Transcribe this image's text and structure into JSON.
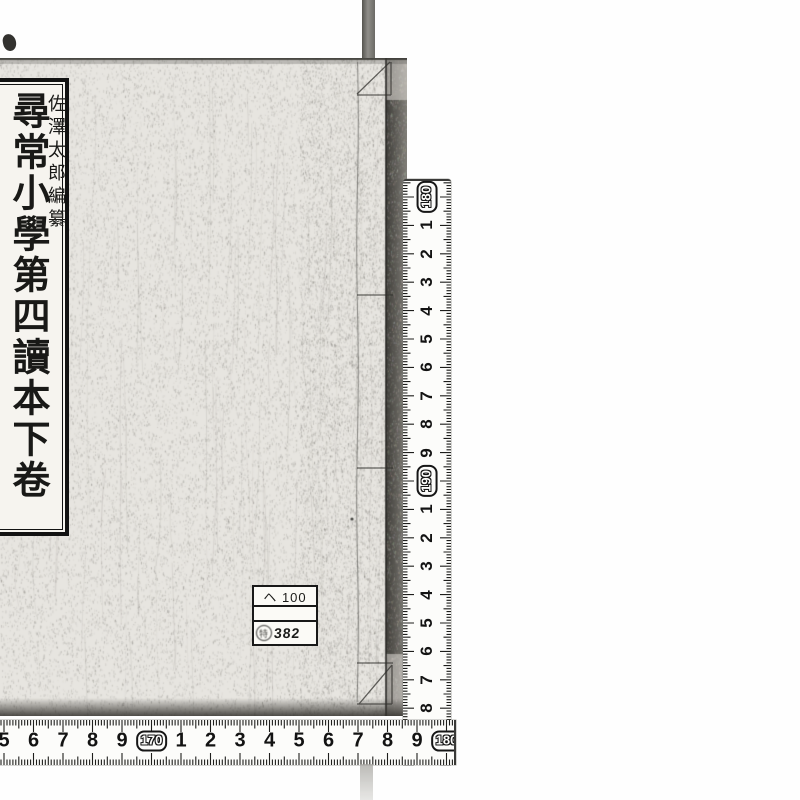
{
  "book": {
    "title_label": {
      "main_title": "尋常小學第四讀本",
      "volume": "下卷",
      "editor": "佐澤太郎編纂"
    },
    "call_number_label": {
      "line1": "ヘ 100",
      "line2": "",
      "line3": "382",
      "stamp_glyph": "特"
    }
  },
  "rulers": {
    "vertical": {
      "sequence": [
        {
          "label": "180",
          "badge": true
        },
        {
          "label": "1"
        },
        {
          "label": "2"
        },
        {
          "label": "3"
        },
        {
          "label": "4"
        },
        {
          "label": "5"
        },
        {
          "label": "6"
        },
        {
          "label": "7"
        },
        {
          "label": "8"
        },
        {
          "label": "9"
        },
        {
          "label": "190",
          "badge": true
        },
        {
          "label": "1"
        },
        {
          "label": "2"
        },
        {
          "label": "3"
        },
        {
          "label": "4"
        },
        {
          "label": "5"
        },
        {
          "label": "6"
        },
        {
          "label": "7"
        },
        {
          "label": "8"
        },
        {
          "label": "9"
        }
      ]
    },
    "horizontal": {
      "sequence": [
        {
          "label": "5"
        },
        {
          "label": "6"
        },
        {
          "label": "7"
        },
        {
          "label": "8"
        },
        {
          "label": "9"
        },
        {
          "label": "170",
          "badge": true
        },
        {
          "label": "1"
        },
        {
          "label": "2"
        },
        {
          "label": "3"
        },
        {
          "label": "4"
        },
        {
          "label": "5"
        },
        {
          "label": "6"
        },
        {
          "label": "7"
        },
        {
          "label": "8"
        },
        {
          "label": "9"
        },
        {
          "label": "180",
          "badge": true
        }
      ]
    }
  },
  "colors": {
    "background": "#fefefe",
    "cover_base": "#e7e5e0",
    "edge_shadow": "#55534e",
    "ink": "#141414",
    "ruler_face": "#fcfcfa"
  }
}
